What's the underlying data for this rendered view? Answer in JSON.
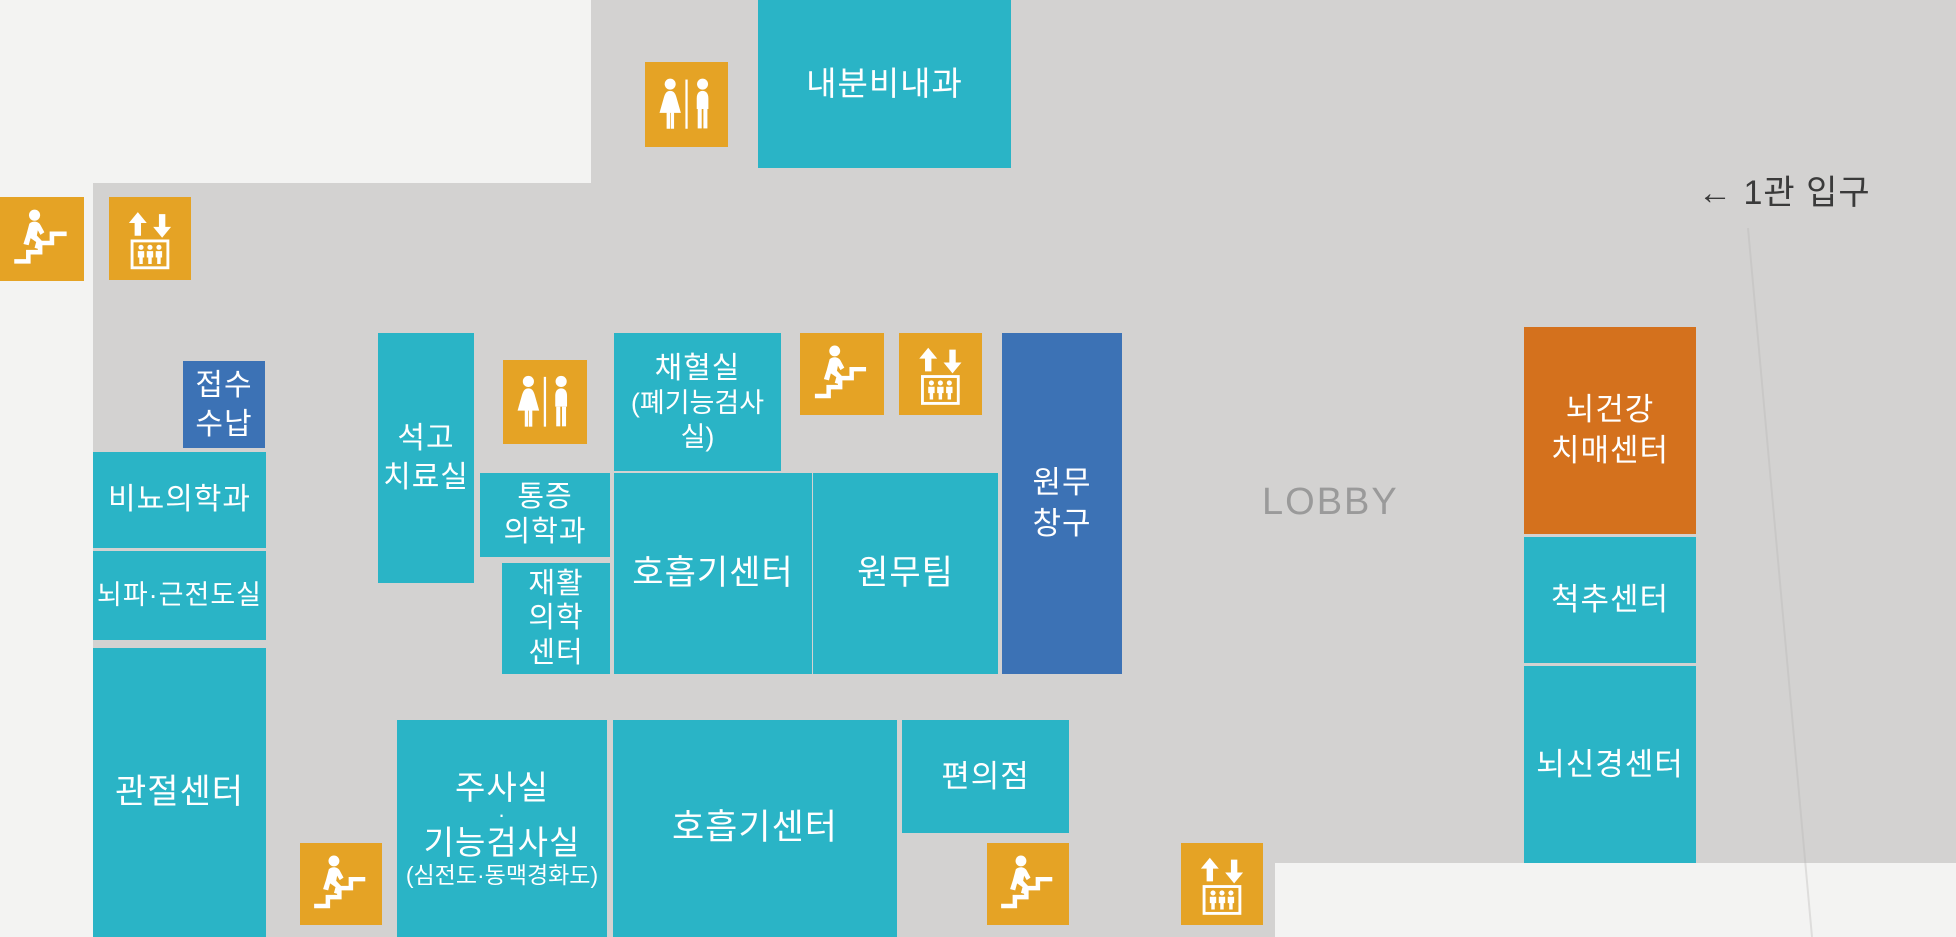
{
  "labels": {
    "lobby": "LOBBY",
    "entrance": "← 1관 입구"
  },
  "rooms": {
    "endocrinology": {
      "label": "내분비내과"
    },
    "reception": {
      "line1": "접수",
      "line2": "수납"
    },
    "urology": {
      "label": "비뇨의학과"
    },
    "eeg_emg": {
      "label": "뇌파·근전도실"
    },
    "joint_center": {
      "label": "관절센터"
    },
    "cast_room": {
      "line1": "석고",
      "line2": "치료실"
    },
    "blood_collection": {
      "line1": "채혈실",
      "line2": "(폐기능검사실)"
    },
    "pain_medicine": {
      "line1": "통증",
      "line2": "의학과"
    },
    "rehab_center": {
      "line1": "재활",
      "line2": "의학",
      "line3": "센터"
    },
    "respiratory_upper": {
      "label": "호흡기센터"
    },
    "admin_team": {
      "label": "원무팀"
    },
    "admin_windows": {
      "line1": "원무",
      "line2": "창구"
    },
    "injection_room": {
      "line1": "주사실",
      "line2": "·",
      "line3": "기능검사실",
      "line4": "(심전도·동맥경화도)"
    },
    "respiratory_lower": {
      "label": "호흡기센터"
    },
    "convenience_store": {
      "label": "편의점"
    },
    "brain_dementia_center": {
      "line1": "뇌건강",
      "line2": "치매센터"
    },
    "spine_center": {
      "label": "척추센터"
    },
    "neuro_center": {
      "label": "뇌신경센터"
    }
  },
  "icons": {
    "stairs": "stairs-icon",
    "elevator": "elevator-icon",
    "restroom": "restroom-icon"
  },
  "colors": {
    "room_teal": "#2ab4c6",
    "room_blue": "#3c72b5",
    "room_orange": "#d4711d",
    "icon_yellow": "#e5a325",
    "floor_gray": "#d3d2d1",
    "page_background": "#f3f3f2",
    "lobby_text": "#9a9a9a",
    "entrance_text": "#3a3a3a",
    "room_text": "#ffffff"
  }
}
